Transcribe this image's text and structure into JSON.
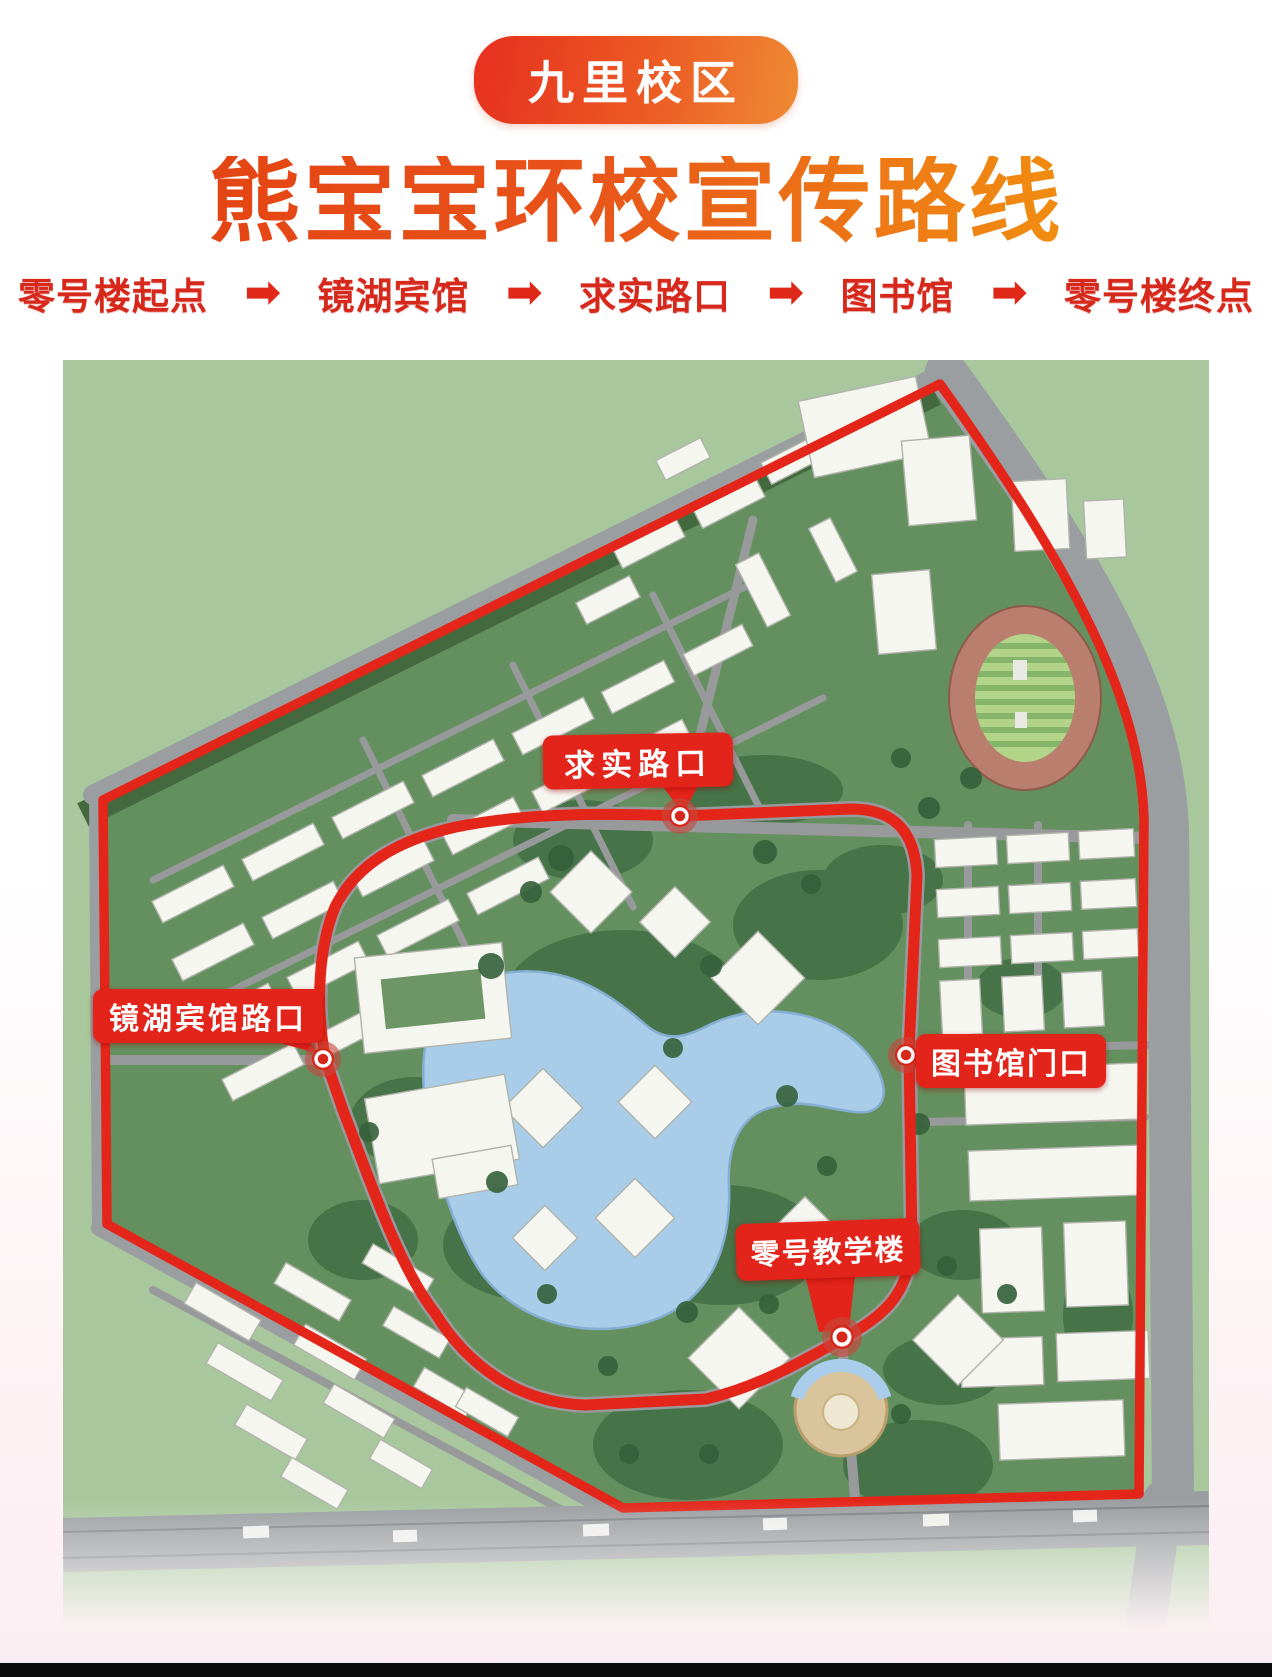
{
  "page": {
    "campus_badge": "九里校区",
    "title": "熊宝宝环校宣传路线"
  },
  "route_bar": {
    "arrow": "➡",
    "stops": [
      "零号楼起点",
      "镜湖宾馆",
      "求实路口",
      "图书馆",
      "零号楼终点"
    ]
  },
  "map": {
    "markers": [
      {
        "label": "求实路口"
      },
      {
        "label": "镜湖宾馆路口"
      },
      {
        "label": "图书馆门口"
      },
      {
        "label": "零号教学楼"
      }
    ]
  },
  "colors": {
    "badge_gradient_start": "#e7331f",
    "badge_gradient_end": "#ee8b33",
    "title_orange": "#e8531a",
    "route_text_red": "#d7281c",
    "map_label_red": "#e3241b",
    "route_line_red": "#e4261a",
    "lake_blue": "#a9cde9",
    "field_green": "#a8c79d",
    "campus_green": "#64905f",
    "road_gray": "#97999b"
  }
}
